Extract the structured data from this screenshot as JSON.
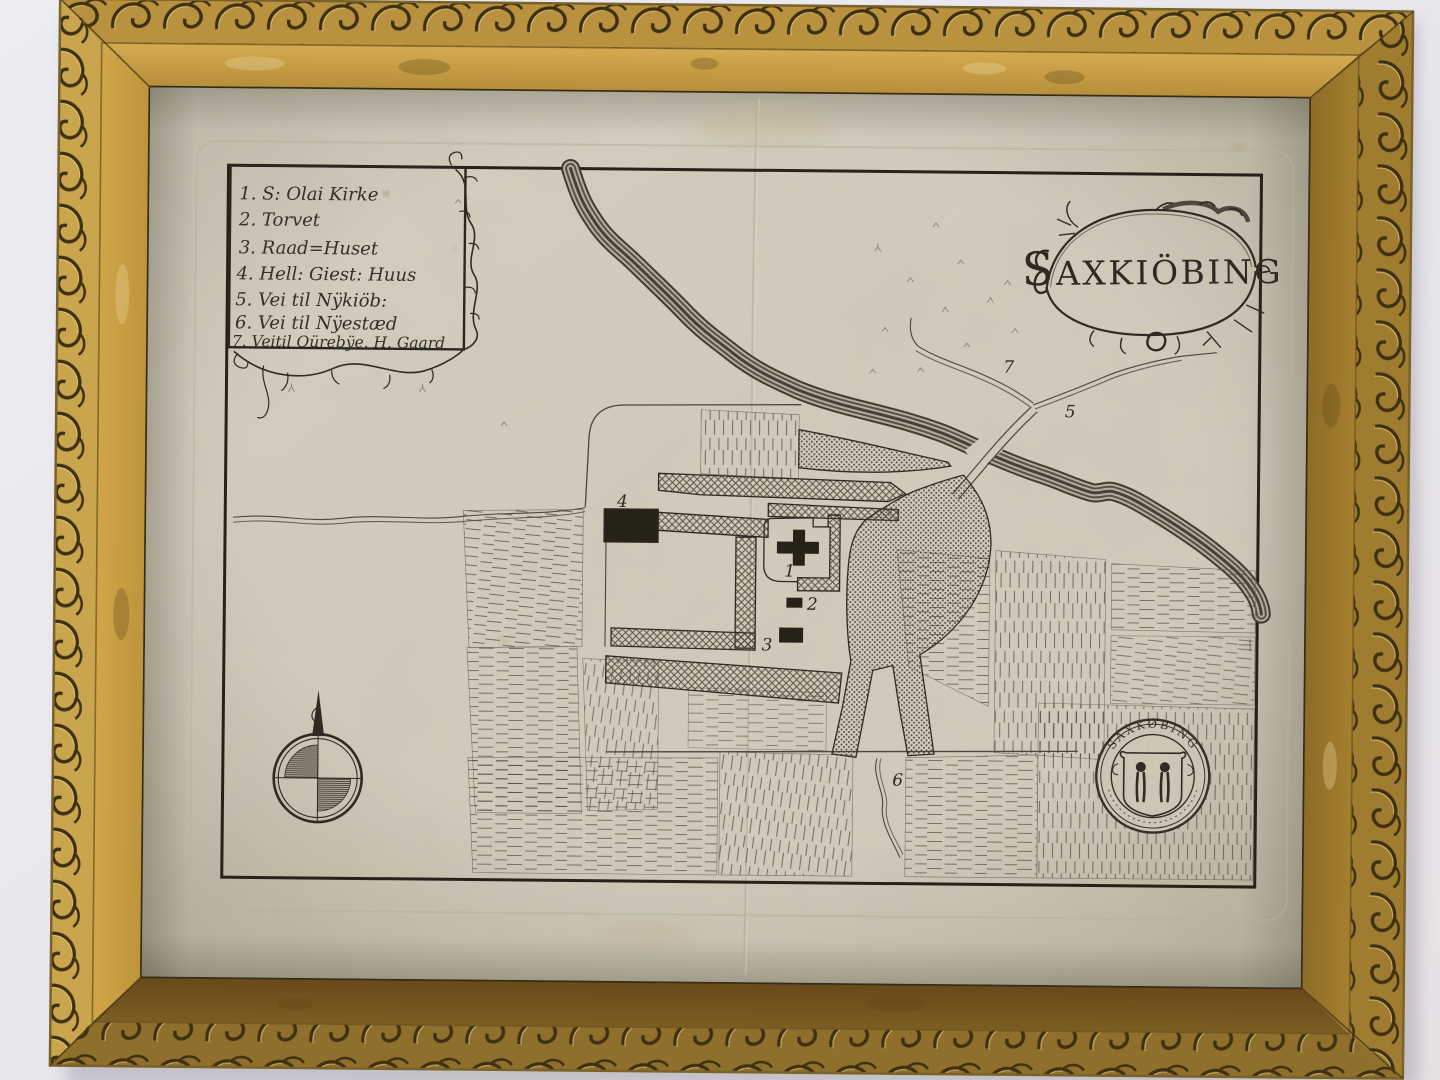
{
  "artwork": {
    "kind": "framed engraved town plan",
    "title_initial": "S",
    "title_rest": "AXKIÖBING",
    "legend_items": [
      "1. S: Olai Kirke",
      "2. Torvet",
      "3. Raad=Huset",
      "4. Hell: Giest: Huus",
      "5. Vei til Nÿkiöb:",
      "6. Vei til Nÿestæd",
      "7. Veitil Oürebÿe. H. Gaard"
    ],
    "markers": {
      "church": "1",
      "torvet": "2",
      "raadhuus": "3",
      "giesthuus": "4",
      "road_nykiobing": "5",
      "road_nyestad": "6",
      "road_oureby": "7"
    },
    "seal_text": "SAXKØBING",
    "colors": {
      "frame_gold": "#c49a42",
      "frame_dark_bronze": "#6b5120",
      "paper": "#d3cdbd",
      "ink": "#2f2b22",
      "wall": "#eae8ee"
    }
  }
}
